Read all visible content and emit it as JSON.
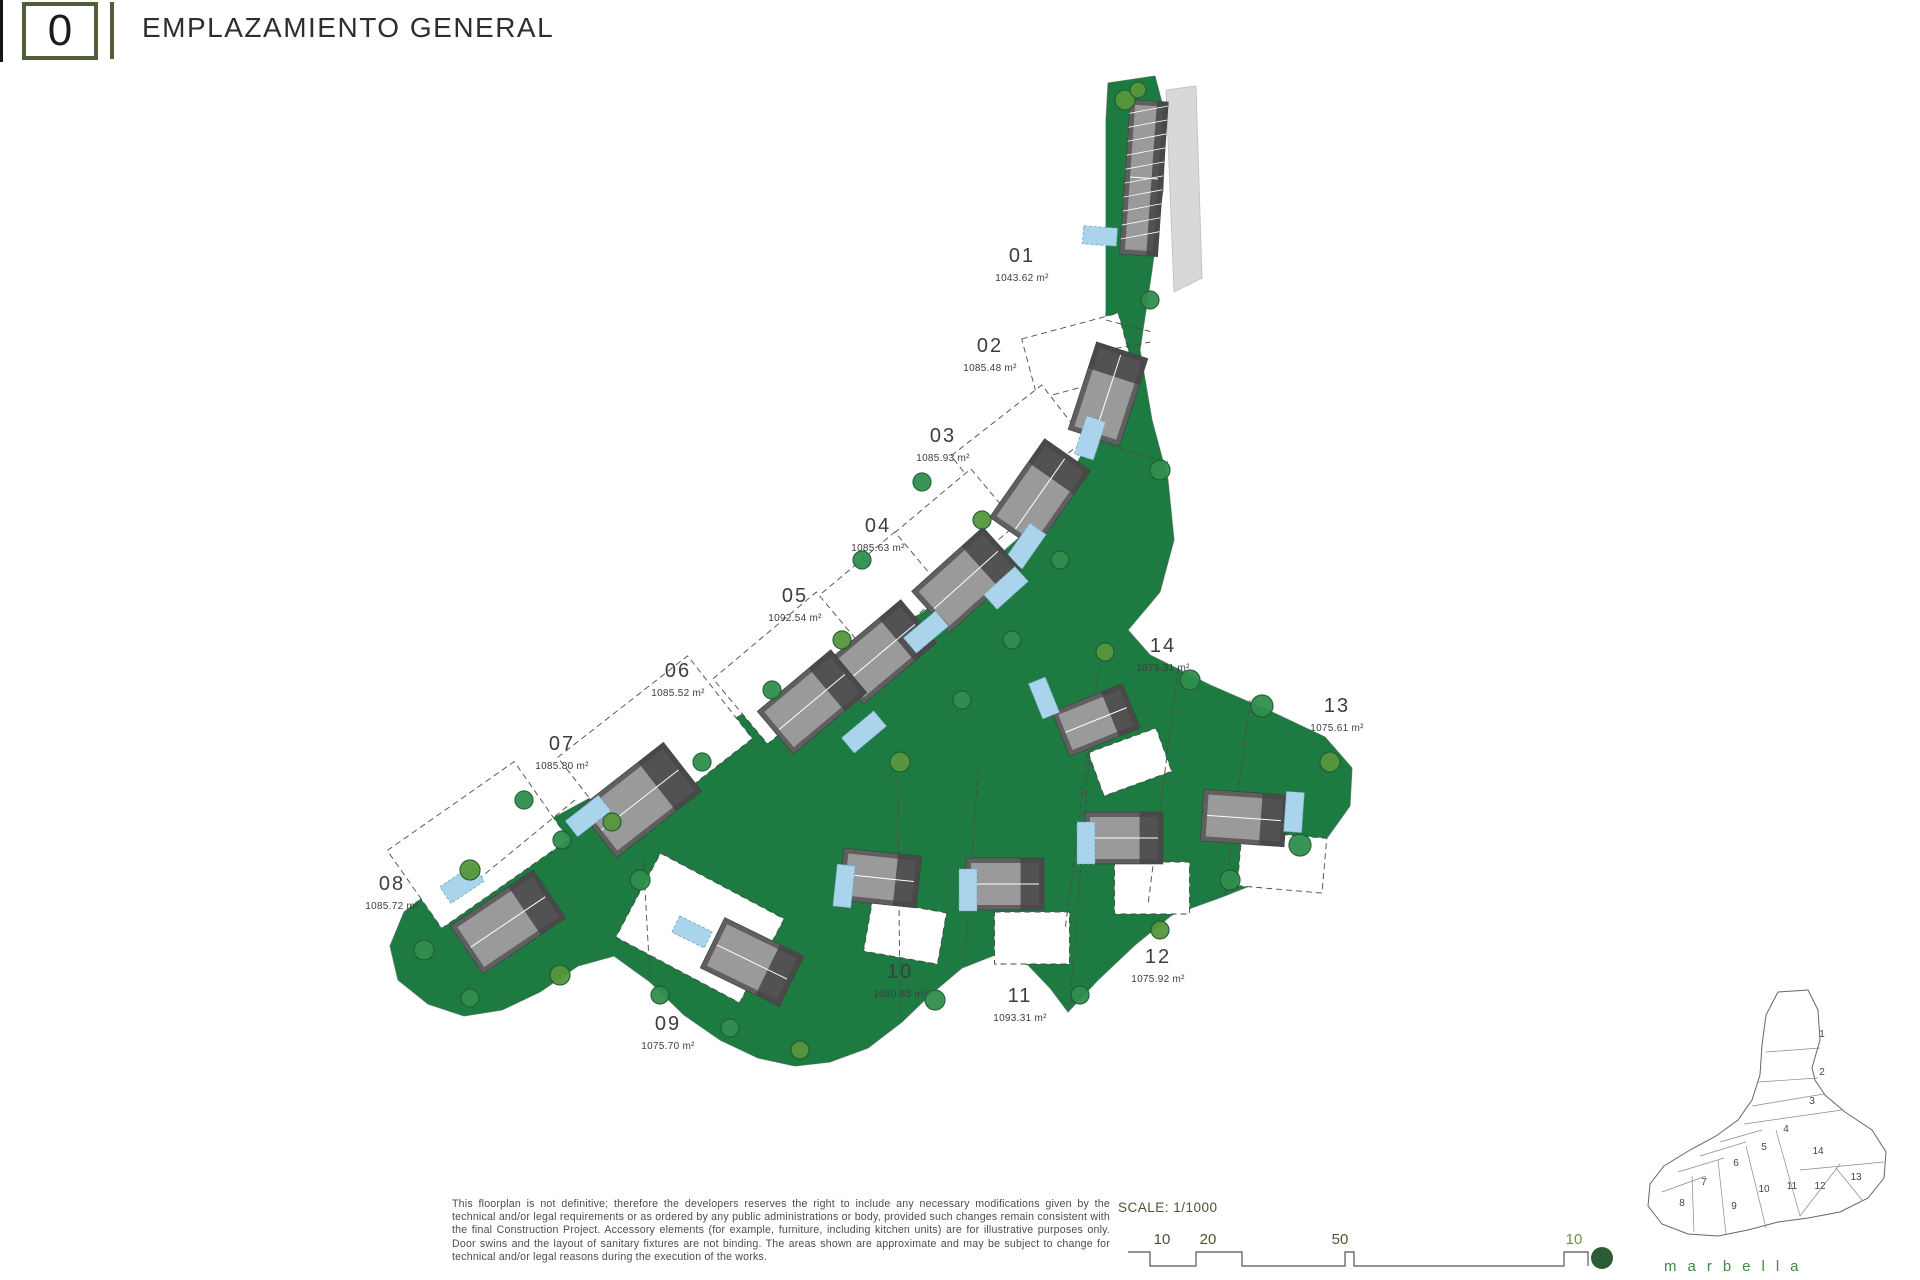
{
  "header": {
    "code": "0",
    "title": "EMPLAZAMIENTO GENERAL"
  },
  "footer": {
    "disclaimer": "This floorplan is not definitive; therefore the developers reserves the right to include any necessary modifications given by the technical and/or legal requirements or as ordered by any public administrations or body, provided such changes remain consistent with the final Construction Project. Accessory elements (for example, furniture, including kitchen units) are for illustrative purposes only. Door swins and the layout of sanitary fixtures are not binding. The areas shown are approximate and may be subject to change for technical and/or legal reasons during the execution of the works.",
    "scale_label": "SCALE: 1/1000",
    "bar_ticks": [
      {
        "t": "10",
        "x": 1162,
        "c": "#4c5530"
      },
      {
        "t": "20",
        "x": 1208,
        "c": "#4c5530"
      },
      {
        "t": "50",
        "x": 1340,
        "c": "#4c5530"
      },
      {
        "t": "10",
        "x": 1574,
        "c": "#71923f"
      }
    ],
    "bar_path": "M1128 1252 H1150 V1266 H1196 V1252 H1242 V1266 H1345 V1252 H1354 V1266 H1564 V1252 H1588 V1266",
    "dot": {
      "x": 1602,
      "y": 1258,
      "r": 11,
      "color": "#2d5b35"
    }
  },
  "brand": "marbella",
  "colors": {
    "lawn": "#1d7a41",
    "tree_fill": "#2f8f4e",
    "tree_alt": "#57963c",
    "tree_stroke": "#1f5c33",
    "villa": "#5f5f5f",
    "villa_dark": "#454545",
    "roof": "#9a9a9a",
    "ridge": "#ffffff",
    "pool": "#a9d4ec",
    "pool_edge": "#6fa5c4",
    "dash": "#4a4a4a",
    "outline": "#8a8a8a",
    "road": "#d8d8d8",
    "label": "#3d3d3d"
  },
  "plan": {
    "parcel": [
      [
        1108,
        83
      ],
      [
        1155,
        76
      ],
      [
        1166,
        118
      ],
      [
        1163,
        190
      ],
      [
        1152,
        270
      ],
      [
        1140,
        350
      ],
      [
        1152,
        420
      ],
      [
        1168,
        480
      ],
      [
        1174,
        540
      ],
      [
        1160,
        592
      ],
      [
        1128,
        630
      ],
      [
        1150,
        655
      ],
      [
        1210,
        685
      ],
      [
        1272,
        712
      ],
      [
        1325,
        737
      ],
      [
        1352,
        768
      ],
      [
        1350,
        806
      ],
      [
        1322,
        845
      ],
      [
        1275,
        876
      ],
      [
        1222,
        897
      ],
      [
        1172,
        915
      ],
      [
        1135,
        945
      ],
      [
        1098,
        980
      ],
      [
        1068,
        1012
      ],
      [
        1050,
        988
      ],
      [
        1028,
        965
      ],
      [
        995,
        955
      ],
      [
        962,
        968
      ],
      [
        930,
        995
      ],
      [
        902,
        1022
      ],
      [
        868,
        1048
      ],
      [
        830,
        1062
      ],
      [
        795,
        1066
      ],
      [
        758,
        1058
      ],
      [
        720,
        1040
      ],
      [
        684,
        1015
      ],
      [
        650,
        982
      ],
      [
        614,
        956
      ],
      [
        578,
        966
      ],
      [
        540,
        992
      ],
      [
        502,
        1010
      ],
      [
        464,
        1016
      ],
      [
        428,
        1004
      ],
      [
        398,
        980
      ],
      [
        390,
        946
      ],
      [
        404,
        912
      ],
      [
        440,
        884
      ],
      [
        492,
        852
      ],
      [
        553,
        818
      ],
      [
        614,
        785
      ],
      [
        676,
        751
      ],
      [
        737,
        717
      ],
      [
        798,
        683
      ],
      [
        860,
        649
      ],
      [
        920,
        614
      ],
      [
        980,
        572
      ],
      [
        1030,
        528
      ],
      [
        1066,
        485
      ],
      [
        1090,
        438
      ],
      [
        1102,
        385
      ],
      [
        1106,
        310
      ],
      [
        1106,
        200
      ],
      [
        1106,
        120
      ]
    ],
    "road": [
      [
        1166,
        90
      ],
      [
        1196,
        86
      ],
      [
        1202,
        278
      ],
      [
        1174,
        292
      ]
    ],
    "dash_lines": [
      [
        1102,
        643,
        1065,
        930
      ],
      [
        1178,
        668,
        1148,
        905
      ],
      [
        1250,
        700,
        1225,
        895
      ],
      [
        978,
        770,
        965,
        960
      ],
      [
        1090,
        750,
        1070,
        1005
      ],
      [
        898,
        780,
        900,
        1018
      ],
      [
        642,
        835,
        650,
        978
      ],
      [
        575,
        800,
        480,
        878
      ],
      [
        1096,
        352,
        1150,
        342
      ],
      [
        1090,
        440,
        1168,
        462
      ],
      [
        1106,
        320,
        1152,
        332
      ]
    ],
    "trees": [
      [
        1125,
        100,
        10
      ],
      [
        1150,
        300,
        9
      ],
      [
        1160,
        470,
        10
      ],
      [
        1105,
        652,
        9
      ],
      [
        1190,
        680,
        10
      ],
      [
        1262,
        706,
        11
      ],
      [
        1330,
        762,
        10
      ],
      [
        1300,
        845,
        11
      ],
      [
        1230,
        880,
        10
      ],
      [
        1160,
        930,
        9
      ],
      [
        1080,
        995,
        9
      ],
      [
        935,
        1000,
        10
      ],
      [
        800,
        1050,
        9
      ],
      [
        730,
        1028,
        9
      ],
      [
        660,
        995,
        9
      ],
      [
        560,
        975,
        10
      ],
      [
        470,
        998,
        9
      ],
      [
        424,
        950,
        10
      ],
      [
        470,
        870,
        10
      ],
      [
        562,
        840,
        9
      ],
      [
        640,
        880,
        10
      ],
      [
        900,
        762,
        10
      ],
      [
        962,
        700,
        9
      ],
      [
        1012,
        640,
        9
      ],
      [
        842,
        640,
        9
      ],
      [
        772,
        690,
        9
      ],
      [
        702,
        762,
        9
      ],
      [
        612,
        822,
        9
      ],
      [
        524,
        800,
        9
      ],
      [
        1060,
        560,
        9
      ],
      [
        982,
        520,
        9
      ],
      [
        922,
        482,
        9
      ],
      [
        862,
        560,
        9
      ],
      [
        1138,
        90,
        8
      ]
    ]
  },
  "plots": [
    {
      "num": "01",
      "area": "1043.62 m²",
      "lx": 1022,
      "ly": 262,
      "villa": [
        1144,
        178,
        38,
        155,
        4
      ],
      "hatch": true,
      "pool": [
        1100,
        236,
        34,
        18,
        4
      ]
    },
    {
      "num": "02",
      "area": "1085.48 m²",
      "lx": 990,
      "ly": 352,
      "wedge": [
        1078,
        356,
        100,
        62,
        -15
      ],
      "villa": [
        1108,
        394,
        92,
        54,
        -72
      ],
      "pool": [
        1090,
        438,
        40,
        20,
        -72
      ]
    },
    {
      "num": "03",
      "area": "1085.93 m²",
      "lx": 943,
      "ly": 442,
      "wedge": [
        1018,
        448,
        115,
        70,
        -38
      ],
      "villa": [
        1040,
        494,
        96,
        56,
        -55
      ],
      "pool": [
        1026,
        546,
        42,
        20,
        -55
      ]
    },
    {
      "num": "04",
      "area": "1085.63 m²",
      "lx": 878,
      "ly": 532,
      "wedge": [
        948,
        535,
        120,
        72,
        -40
      ],
      "villa": [
        966,
        580,
        96,
        56,
        -42
      ],
      "pool": [
        1006,
        588,
        42,
        20,
        -42
      ]
    },
    {
      "num": "05",
      "area": "1092.54 m²",
      "lx": 795,
      "ly": 602,
      "wedge": [
        872,
        602,
        125,
        78,
        -40
      ],
      "villa": [
        882,
        652,
        96,
        56,
        -40
      ],
      "pool": [
        926,
        632,
        42,
        20,
        -40
      ]
    },
    {
      "num": "06",
      "area": "1085.52 m²",
      "lx": 678,
      "ly": 677,
      "wedge": [
        792,
        668,
        135,
        85,
        -40
      ],
      "villa": [
        812,
        702,
        96,
        56,
        -40
      ],
      "pool": [
        864,
        732,
        42,
        20,
        -40
      ]
    },
    {
      "num": "07",
      "area": "1085.80 m²",
      "lx": 562,
      "ly": 750,
      "wedge": [
        655,
        748,
        165,
        105,
        -38
      ],
      "villa": [
        640,
        800,
        108,
        62,
        -38
      ],
      "pool": [
        588,
        816,
        42,
        20,
        -38
      ]
    },
    {
      "num": "08",
      "area": "1085.72 m²",
      "lx": 392,
      "ly": 890,
      "wedge": [
        478,
        845,
        155,
        95,
        -35
      ],
      "villa": [
        508,
        922,
        100,
        58,
        -34
      ],
      "pool": [
        462,
        884,
        40,
        20,
        -34
      ]
    },
    {
      "num": "09",
      "area": "1075.70 m²",
      "lx": 668,
      "ly": 1030,
      "wedge": [
        700,
        928,
        140,
        95,
        28
      ],
      "villa": [
        752,
        962,
        88,
        56,
        26
      ],
      "pool": [
        692,
        932,
        36,
        18,
        26
      ]
    },
    {
      "num": "10",
      "area": "1080.85 m²",
      "lx": 900,
      "ly": 978,
      "wedge": [
        905,
        932,
        75,
        52,
        10
      ],
      "villa": [
        880,
        878,
        78,
        52,
        6
      ],
      "pool": [
        844,
        886,
        18,
        42,
        6
      ]
    },
    {
      "num": "11",
      "area": "1093.31 m²",
      "lx": 1020,
      "ly": 1002,
      "wedge": [
        1032,
        938,
        75,
        52,
        0
      ],
      "villa": [
        1005,
        884,
        78,
        52,
        0
      ],
      "pool": [
        968,
        890,
        18,
        42,
        0
      ]
    },
    {
      "num": "12",
      "area": "1075.92 m²",
      "lx": 1158,
      "ly": 963,
      "wedge": [
        1152,
        888,
        75,
        52,
        0
      ],
      "villa": [
        1124,
        838,
        78,
        52,
        0
      ],
      "pool": [
        1086,
        843,
        18,
        42,
        0
      ]
    },
    {
      "num": "13",
      "area": "1075.61 m²",
      "lx": 1337,
      "ly": 712,
      "wedge": [
        1282,
        862,
        85,
        55,
        5
      ],
      "villa": [
        1244,
        818,
        84,
        52,
        4
      ],
      "pool": [
        1294,
        812,
        18,
        40,
        4
      ]
    },
    {
      "num": "14",
      "area": "1079.31 m²",
      "lx": 1163,
      "ly": 652,
      "wedge": [
        1130,
        762,
        72,
        46,
        -20
      ],
      "villa": [
        1096,
        720,
        76,
        48,
        -22
      ],
      "pool": [
        1044,
        698,
        18,
        38,
        -22
      ]
    }
  ],
  "keyplan": {
    "outline": [
      [
        1778,
        992
      ],
      [
        1808,
        990
      ],
      [
        1818,
        1010
      ],
      [
        1820,
        1040
      ],
      [
        1812,
        1068
      ],
      [
        1815,
        1080
      ],
      [
        1825,
        1095
      ],
      [
        1845,
        1112
      ],
      [
        1872,
        1130
      ],
      [
        1886,
        1152
      ],
      [
        1884,
        1178
      ],
      [
        1868,
        1198
      ],
      [
        1840,
        1212
      ],
      [
        1808,
        1218
      ],
      [
        1778,
        1222
      ],
      [
        1748,
        1230
      ],
      [
        1718,
        1236
      ],
      [
        1688,
        1234
      ],
      [
        1662,
        1224
      ],
      [
        1648,
        1206
      ],
      [
        1650,
        1184
      ],
      [
        1664,
        1166
      ],
      [
        1690,
        1150
      ],
      [
        1716,
        1136
      ],
      [
        1738,
        1120
      ],
      [
        1752,
        1100
      ],
      [
        1760,
        1075
      ],
      [
        1762,
        1045
      ],
      [
        1766,
        1015
      ]
    ],
    "lines": [
      [
        1766,
        1052,
        1820,
        1048
      ],
      [
        1758,
        1082,
        1818,
        1078
      ],
      [
        1752,
        1106,
        1824,
        1094
      ],
      [
        1744,
        1124,
        1842,
        1110
      ],
      [
        1720,
        1142,
        1762,
        1130
      ],
      [
        1700,
        1156,
        1746,
        1142
      ],
      [
        1678,
        1172,
        1724,
        1158
      ],
      [
        1662,
        1192,
        1706,
        1176
      ],
      [
        1776,
        1130,
        1800,
        1216
      ],
      [
        1800,
        1216,
        1840,
        1164
      ],
      [
        1746,
        1146,
        1766,
        1228
      ],
      [
        1718,
        1160,
        1726,
        1234
      ],
      [
        1692,
        1176,
        1694,
        1232
      ],
      [
        1800,
        1170,
        1884,
        1162
      ],
      [
        1836,
        1168,
        1862,
        1200
      ]
    ],
    "numbers": [
      {
        "n": "1",
        "x": 1822,
        "y": 1037
      },
      {
        "n": "2",
        "x": 1822,
        "y": 1075
      },
      {
        "n": "3",
        "x": 1812,
        "y": 1104
      },
      {
        "n": "4",
        "x": 1786,
        "y": 1132
      },
      {
        "n": "5",
        "x": 1764,
        "y": 1150
      },
      {
        "n": "14",
        "x": 1818,
        "y": 1154
      },
      {
        "n": "6",
        "x": 1736,
        "y": 1166
      },
      {
        "n": "7",
        "x": 1704,
        "y": 1185
      },
      {
        "n": "13",
        "x": 1856,
        "y": 1180
      },
      {
        "n": "8",
        "x": 1682,
        "y": 1206
      },
      {
        "n": "9",
        "x": 1734,
        "y": 1209
      },
      {
        "n": "10",
        "x": 1764,
        "y": 1192
      },
      {
        "n": "11",
        "x": 1792,
        "y": 1189
      },
      {
        "n": "12",
        "x": 1820,
        "y": 1189
      }
    ]
  }
}
